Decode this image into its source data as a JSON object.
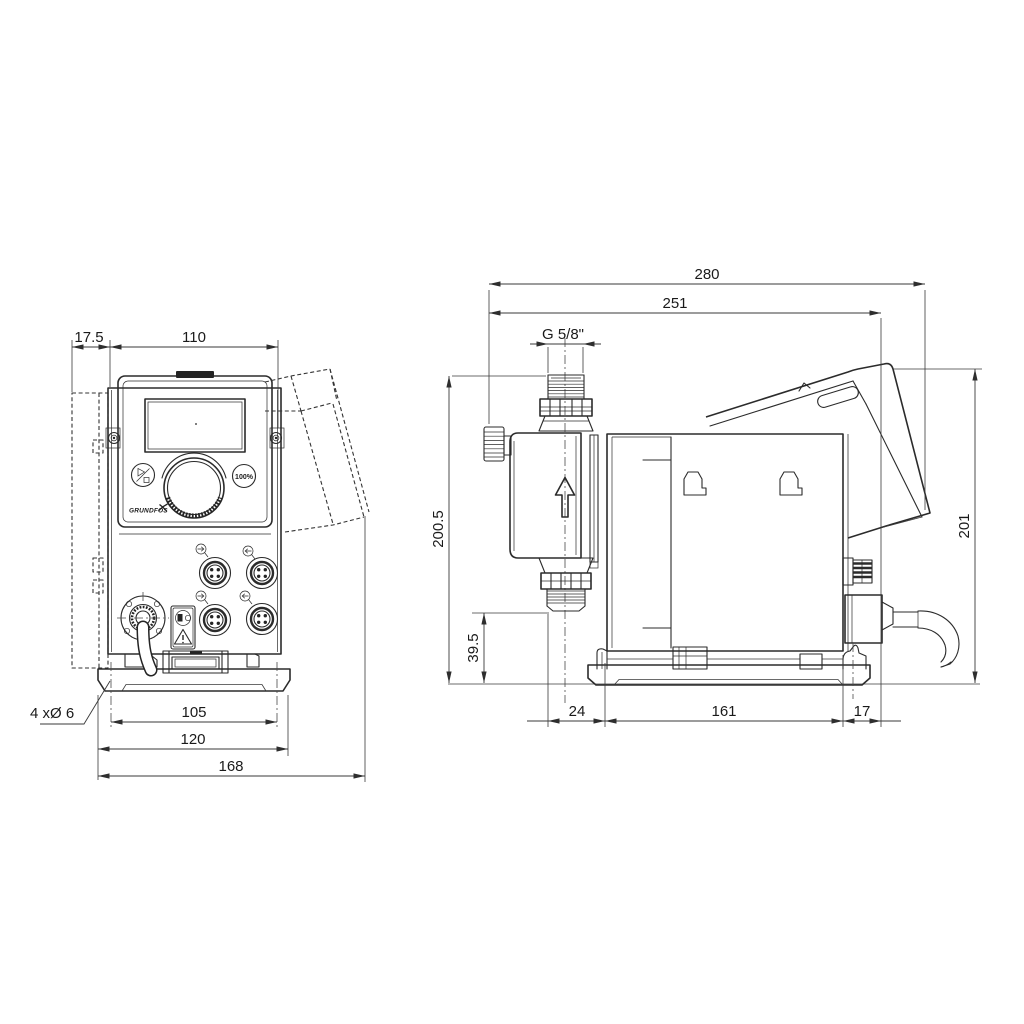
{
  "front": {
    "dims": {
      "offset": "17.5",
      "width": "110",
      "hole_spacing": "105",
      "plate_width": "120",
      "overall_width": "168"
    },
    "holes_label": "4 xØ 6",
    "panel": {
      "boost_button": "100%",
      "brand": "GRUNDFOS"
    }
  },
  "side": {
    "dims": {
      "overall_depth": "280",
      "housing_depth": "251",
      "connection_thread": "G 5/8\"",
      "height_to_connection": "200.5",
      "valve_clearance": "39.5",
      "front_overhang": "24",
      "base_depth": "161",
      "rear_overhang": "17",
      "overall_height": "201"
    }
  }
}
